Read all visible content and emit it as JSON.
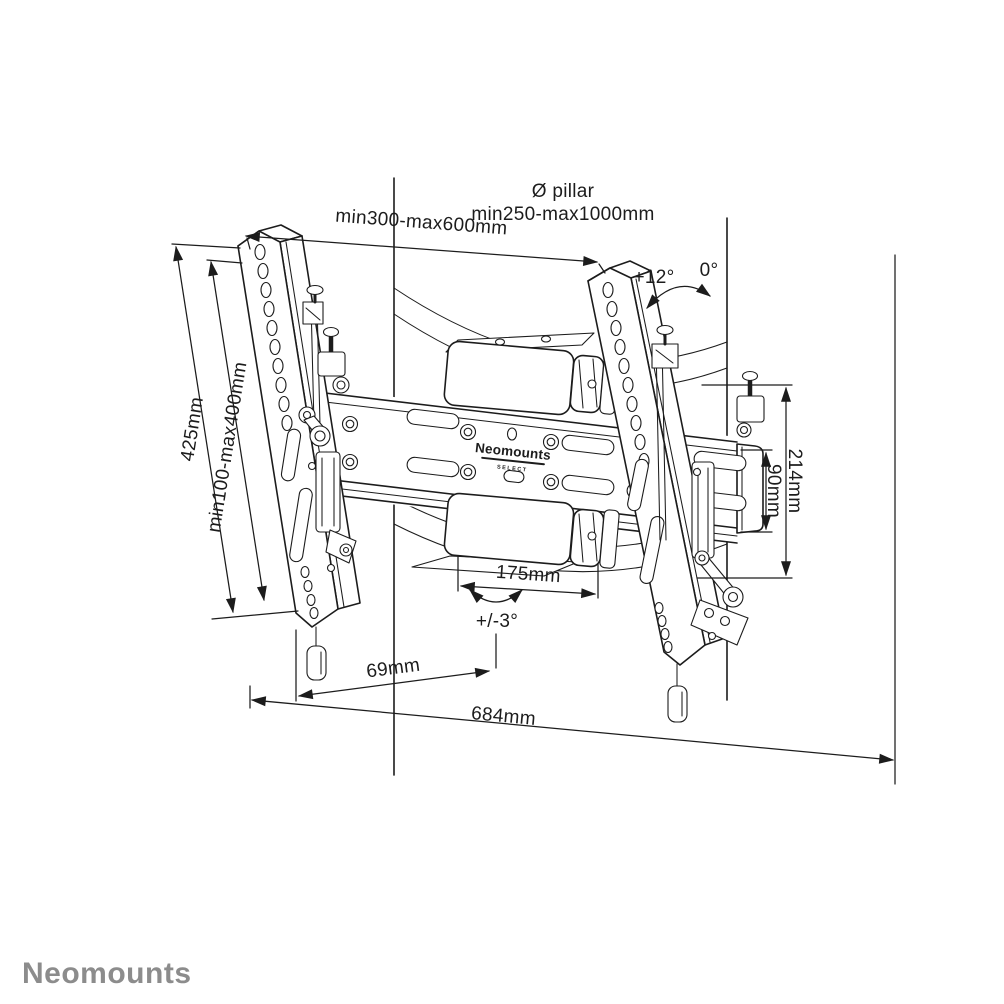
{
  "drawing": {
    "type": "technical-dimension-drawing",
    "subject": "pillar TV mount",
    "annotations": {
      "pillar_label_line1": "Ø pillar",
      "pillar_label_line2": "min250-max1000mm",
      "mount_width_range": "min300-max600mm",
      "bracket_height": "425mm",
      "vesa_height_range": "min100-max400mm",
      "assembly_height": "214mm",
      "rail_height": "90mm",
      "strap_box_width": "175mm",
      "offset_depth": "69mm",
      "total_width": "684mm",
      "tilt_angle_max": "+12°",
      "tilt_angle_zero": "0°",
      "swivel_angle": "+/-3°"
    },
    "brand_on_device": {
      "name": "Neomounts",
      "series": "SELECT"
    },
    "footer_logo": "Neomounts",
    "colors": {
      "line": "#1c1c1c",
      "background": "#ffffff",
      "footer_logo_gray": "#8c8c8c"
    }
  }
}
